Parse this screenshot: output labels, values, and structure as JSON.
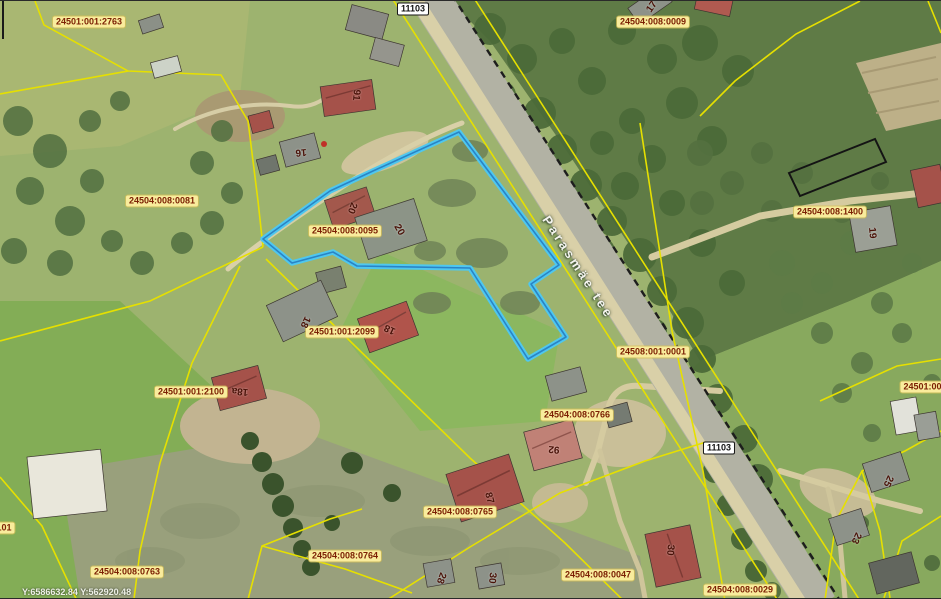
{
  "map": {
    "road_name": "Parasmäe tee",
    "coordinates_readout": "Y:6586632.84 Y:562920.48",
    "selected_parcel_id": "24504:008:0095",
    "colors": {
      "highlight_outline": "#4fc7ee",
      "highlight_core": "#2a84c6",
      "parcel_boundary": "#e6e000",
      "parcel_label_bg": "#f9ec9c",
      "parcel_label_text": "#7c2004",
      "house_number_text": "#4a1208",
      "road_badge_bg": "#ffffff",
      "road_surface": "#b2b2a4"
    }
  },
  "road_badges": [
    {
      "text": "11103",
      "x": 413,
      "y": 8
    },
    {
      "text": "11103",
      "x": 719,
      "y": 447
    }
  ],
  "parcel_labels": [
    {
      "text": "24501:001:2763",
      "x": 89,
      "y": 21
    },
    {
      "text": "24504:008:0009",
      "x": 653,
      "y": 21
    },
    {
      "text": "24504:008:0081",
      "x": 162,
      "y": 200
    },
    {
      "text": "24504:008:0095",
      "x": 345,
      "y": 230
    },
    {
      "text": "24504:008:1400",
      "x": 830,
      "y": 211
    },
    {
      "text": "24508:001:0001",
      "x": 653,
      "y": 351
    },
    {
      "text": "24501:001:2099",
      "x": 342,
      "y": 331
    },
    {
      "text": "24501:001:2100",
      "x": 191,
      "y": 391
    },
    {
      "text": "24504:008:0766",
      "x": 577,
      "y": 414
    },
    {
      "text": "24504:008:0765",
      "x": 460,
      "y": 511
    },
    {
      "text": "24504:008:0764",
      "x": 345,
      "y": 555
    },
    {
      "text": "24504:008:0763",
      "x": 127,
      "y": 571
    },
    {
      "text": "24504:008:0047",
      "x": 598,
      "y": 574
    },
    {
      "text": "24504:008:0029",
      "x": 740,
      "y": 589
    },
    {
      "text": "24501:001",
      "x": 925,
      "y": 386
    },
    {
      "text": "101",
      "x": 4,
      "y": 527
    }
  ],
  "house_numbers": [
    {
      "text": "17",
      "x": 652,
      "y": 6,
      "rot": -55
    },
    {
      "text": "91",
      "x": 356,
      "y": 94,
      "rot": 95
    },
    {
      "text": "16",
      "x": 301,
      "y": 151,
      "rot": 175
    },
    {
      "text": "20",
      "x": 352,
      "y": 207,
      "rot": 110
    },
    {
      "text": "20",
      "x": 399,
      "y": 229,
      "rot": 60
    },
    {
      "text": "19",
      "x": 872,
      "y": 232,
      "rot": 85
    },
    {
      "text": "18",
      "x": 305,
      "y": 321,
      "rot": 115
    },
    {
      "text": "18",
      "x": 390,
      "y": 328,
      "rot": 205
    },
    {
      "text": "18a",
      "x": 240,
      "y": 390,
      "rot": 185
    },
    {
      "text": "92",
      "x": 554,
      "y": 448,
      "rot": 185
    },
    {
      "text": "87",
      "x": 489,
      "y": 497,
      "rot": 75
    },
    {
      "text": "28",
      "x": 441,
      "y": 577,
      "rot": 110
    },
    {
      "text": "30",
      "x": 492,
      "y": 577,
      "rot": 95
    },
    {
      "text": "30",
      "x": 670,
      "y": 549,
      "rot": 95
    },
    {
      "text": "25",
      "x": 888,
      "y": 480,
      "rot": 115
    },
    {
      "text": "23",
      "x": 856,
      "y": 537,
      "rot": 115
    }
  ]
}
